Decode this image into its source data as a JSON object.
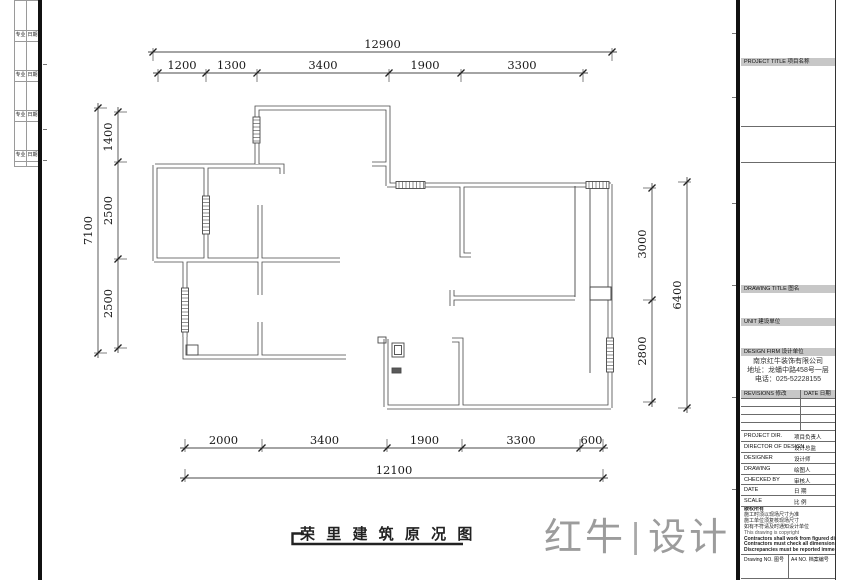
{
  "colors": {
    "wall": "#474747",
    "dim": "#4a4a4a",
    "text": "#1a1a1a",
    "logo": "#9c9c9c"
  },
  "left_strip": {
    "rows": [
      {
        "left": "专业",
        "right": "日期"
      },
      {
        "left": "专业",
        "right": "日期"
      },
      {
        "left": "专业",
        "right": "日期"
      },
      {
        "left": "专业",
        "right": "日期"
      }
    ]
  },
  "drawing_title": {
    "text": "荣 里 建 筑 原 况 图"
  },
  "logo": {
    "left": "红牛",
    "separator": "|",
    "right": "设计"
  },
  "titleblock": {
    "project_title_label": "PROJECT TITLE 项目名称",
    "drawing_title_label": "DRAWING TITLE 图名",
    "unit_label": "UNIT 建设单位",
    "design_firm_label": "DESIGN FIRM 设计单位",
    "company": {
      "name": "南京红牛装饰有限公司",
      "address": "地址：龙蟠中路458号一层",
      "phone": "电话：025-52228155"
    },
    "revisions_label": "REVISIONS 修改",
    "date_col_label": "DATE 日期",
    "rows": [
      {
        "en": "PROJECT DIR.",
        "cn": "项目负责人"
      },
      {
        "en": "DIRECTOR OF DESIGN",
        "cn": "设计总监"
      },
      {
        "en": "DESIGNER",
        "cn": "设计师"
      },
      {
        "en": "DRAWING",
        "cn": "绘图人"
      },
      {
        "en": "CHECKED BY",
        "cn": "审核人"
      },
      {
        "en": "DATE",
        "cn": "日 期"
      },
      {
        "en": "SCALE",
        "cn": "比 例"
      }
    ],
    "notes": [
      "版权所有",
      "施工时须以现场尺寸为准",
      "施工单位须复核现场尺寸",
      "如有不符请及时通知设计单位",
      "This drawing is copyright",
      "Contractors shall work from figured dimensions only",
      "Contractors must check all dimensions on site",
      "Discrepancies must be reported immediately to architects"
    ],
    "drawing_no_label": "Drawing NO. 图号",
    "file_no_label": "A4 NO. 档案编号"
  },
  "dims": {
    "font_size": 11.5,
    "list": [
      {
        "name": "top-overall",
        "orient": "h",
        "pos": 52,
        "ticks": [
          153,
          612
        ],
        "labels": [
          "12900"
        ],
        "dir": 1
      },
      {
        "name": "top-segments",
        "orient": "h",
        "pos": 73,
        "ticks": [
          158,
          206,
          257,
          389,
          461,
          583
        ],
        "labels": [
          "1200",
          "1300",
          "3400",
          "1900",
          "3300"
        ],
        "dir": 1
      },
      {
        "name": "bottom-segments",
        "orient": "h",
        "pos": 448,
        "ticks": [
          185,
          262,
          387,
          462,
          580,
          603
        ],
        "labels": [
          "2000",
          "3400",
          "1900",
          "3300",
          "600"
        ],
        "dir": -1
      },
      {
        "name": "bottom-overall",
        "orient": "h",
        "pos": 478,
        "ticks": [
          185,
          603
        ],
        "labels": [
          "12100"
        ],
        "dir": -1
      },
      {
        "name": "left-overall",
        "orient": "v",
        "pos": 98,
        "ticks": [
          108,
          353
        ],
        "labels": [
          "7100"
        ],
        "dir": 1
      },
      {
        "name": "left-segments",
        "orient": "v",
        "pos": 118,
        "ticks": [
          112,
          162,
          259,
          348
        ],
        "labels": [
          "1400",
          "2500",
          "2500"
        ],
        "dir": 1
      },
      {
        "name": "right-segments",
        "orient": "v",
        "pos": 652,
        "ticks": [
          188,
          300,
          402
        ],
        "labels": [
          "3000",
          "2800"
        ],
        "dir": -1
      },
      {
        "name": "right-overall",
        "orient": "v",
        "pos": 687,
        "ticks": [
          182,
          408
        ],
        "labels": [
          "6400"
        ],
        "dir": -1
      }
    ]
  },
  "plan": {
    "walls": [
      "M257,164 L257,108 L388,108 L388,186",
      "M372,164 L389,164",
      "M387,185 L611,185",
      "M610,184 L610,408",
      "M387,407 L611,407",
      "M386,339 L386,407",
      "M452,340 L461,340 L461,407",
      "M452,290 L452,306 M452,298 L575,298",
      "M462,184 L462,255 L471,255",
      "M155,166 L282,166 L282,174",
      "M155,165 L155,261",
      "M206,166 L206,260",
      "M154,260 L340,260",
      "M260,205 L260,260",
      "M260,260 L260,295",
      "M260,322 L260,357",
      "M185,260 L185,337",
      "M185,330 L185,357 L346,357"
    ],
    "windows": [
      {
        "x": 253,
        "y": 117,
        "w": 7,
        "h": 26
      },
      {
        "x": 202.5,
        "y": 196,
        "w": 7,
        "h": 38
      },
      {
        "x": 181.5,
        "y": 288,
        "w": 7,
        "h": 44
      },
      {
        "x": 396,
        "y": 181.5,
        "w": 29,
        "h": 7
      },
      {
        "x": 586,
        "y": 181.5,
        "w": 23,
        "h": 7
      },
      {
        "x": 606.5,
        "y": 338,
        "w": 7,
        "h": 34
      }
    ],
    "thin_lines": [
      "M590,185 L590,287",
      "M590,300 L590,373",
      "M575,186 L575,297"
    ],
    "pier": {
      "x": 590,
      "y": 287,
      "w": 21,
      "h": 13
    },
    "fixtures": [
      {
        "x": 392,
        "y": 343,
        "w": 12,
        "h": 14,
        "fill": false
      },
      {
        "x": 394.5,
        "y": 345.5,
        "w": 7,
        "h": 9,
        "fill": false
      },
      {
        "x": 186,
        "y": 345,
        "w": 12,
        "h": 10,
        "fill": false
      },
      {
        "x": 392,
        "y": 368,
        "w": 9,
        "h": 5,
        "fill": true
      },
      {
        "x": 378,
        "y": 337,
        "w": 8,
        "h": 6,
        "fill": false
      }
    ],
    "title_underline": "M304,533.5 L292.5,533.5 L292.5,544 L463,544"
  }
}
